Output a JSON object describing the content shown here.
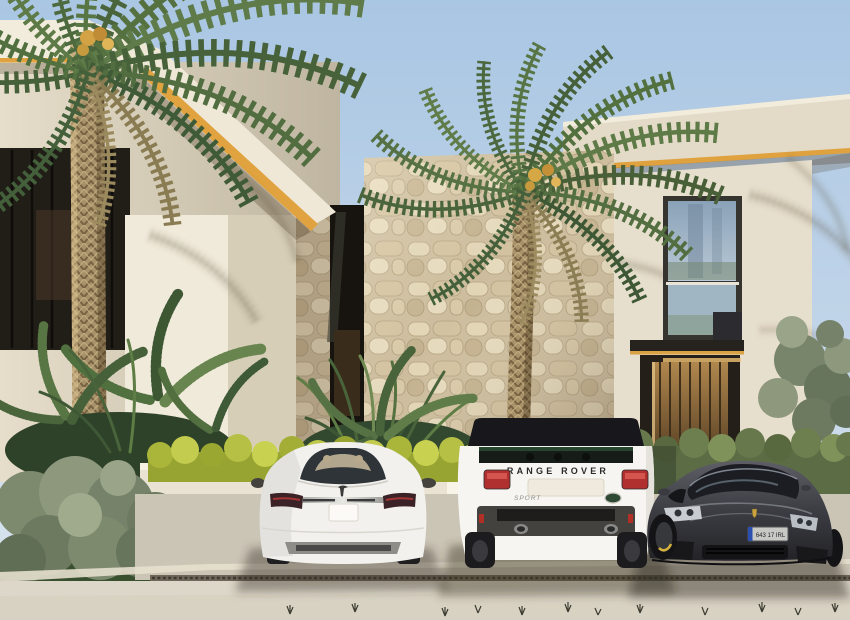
{
  "scene": {
    "description": "Photorealistic architectural rendering of a modern luxury villa with gold-trimmed rooflines, a natural stone feature wall, two tall phoenix palms, landscaped hedges and three cars parked on the driveway",
    "time_of_day": "bright sunny day",
    "sky_color": "#b7cfe7",
    "architecture": {
      "facade_color": "#e8e0cd",
      "accent_trim_color": "#dfa23f",
      "stone_wall_color": "#d5c7a9",
      "features": [
        "gold LED roofline strips",
        "travertine stone feature wall",
        "full-height glazed window with glass balustrade",
        "recessed entrance with warm wood slats"
      ]
    },
    "vegetation": [
      "phoenix palm left",
      "phoenix palm center",
      "areca palms",
      "yellow-green hedge",
      "clipped green hedge",
      "olive shrubs"
    ],
    "vehicles": {
      "left": {
        "type": "white electric sedan",
        "view": "rear",
        "brand_mark": "tesla-t-logo",
        "body_color": "#f2f1ed",
        "plate_text": ""
      },
      "center": {
        "type": "white luxury SUV",
        "view": "rear",
        "tailgate_text": "RANGE ROVER",
        "badge_left": "SPORT",
        "badge_right": "land-rover-oval",
        "body_color": "#f6f5f1",
        "roof_color": "#17171c"
      },
      "right": {
        "type": "dark grey sports saloon",
        "view": "front",
        "brand_mark": "porsche-crest",
        "body_color": "#3f4045",
        "plate_text": "643 17 IRL",
        "brake_caliper_color": "#d6b33c"
      }
    },
    "ground": {
      "paving_color": "#d6d0c2",
      "drainage_channel": "linear slot drain",
      "markings": "seedling sprouts along lower edge"
    }
  }
}
